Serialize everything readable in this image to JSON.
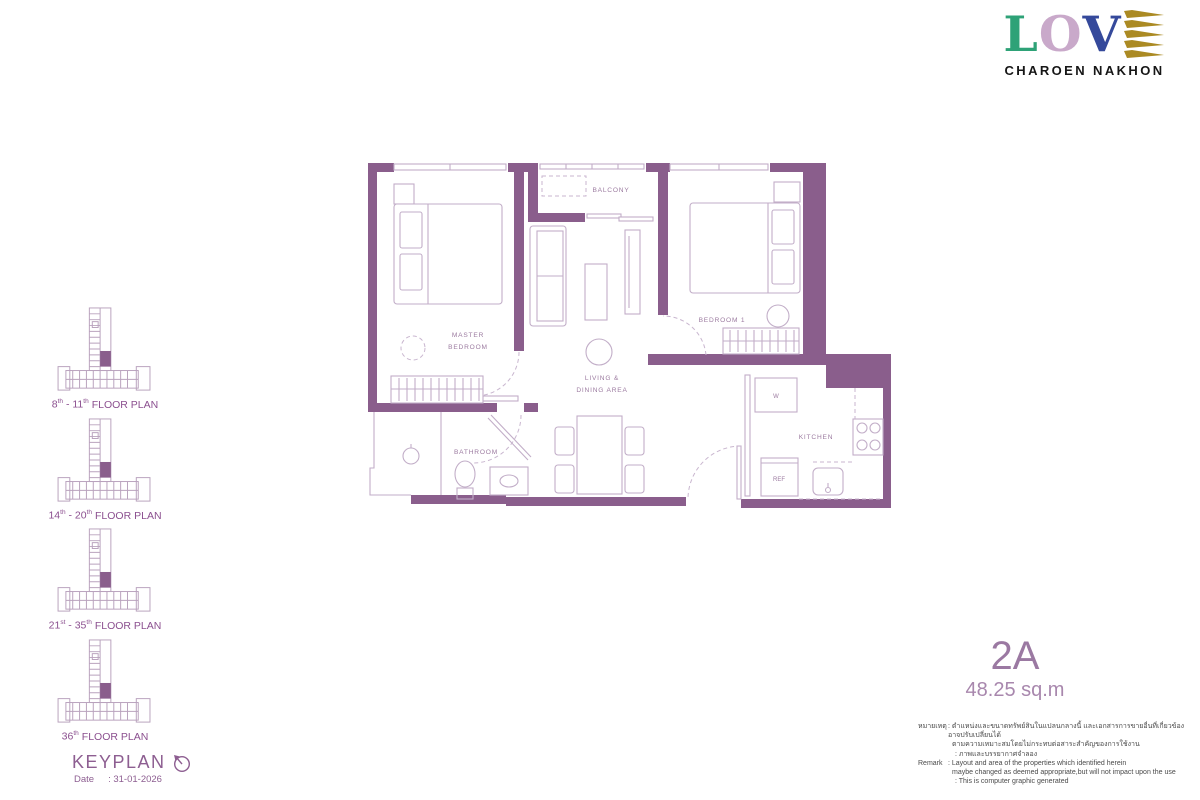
{
  "logo": {
    "letter1": "L",
    "letter2": "O",
    "letter3": "V",
    "subtitle": "CHAROEN NAKHON",
    "colors": {
      "letter1": "#2ea277",
      "letter2": "#c9a9ca",
      "letter3": "#35499b",
      "stylized_e": "#ab8a23",
      "subtitle": "#161616"
    }
  },
  "keyplan_section": {
    "plans": [
      {
        "start": "8",
        "start_sup": "th",
        "dash": " - ",
        "end": "11",
        "end_sup": "th",
        "suffix": "FLOOR PLAN"
      },
      {
        "start": "14",
        "start_sup": "th",
        "dash": " - ",
        "end": "20",
        "end_sup": "th",
        "suffix": "FLOOR PLAN"
      },
      {
        "start": "21",
        "start_sup": "st",
        "dash": " - ",
        "end": "35",
        "end_sup": "th",
        "suffix": "FLOOR PLAN"
      },
      {
        "start": "36",
        "start_sup": "th",
        "dash": "",
        "end": "",
        "end_sup": "",
        "suffix": "FLOOR PLAN"
      }
    ],
    "keyplan_label": "KEYPLAN",
    "date_label": "Date",
    "date_value": ": 31-01-2026"
  },
  "plan_labels": {
    "master_line1": "MASTER",
    "master_line2": "BEDROOM",
    "balcony": "BALCONY",
    "bedroom1": "BEDROOM 1",
    "living_line1": "LIVING &",
    "living_line2": "DINING AREA",
    "bathroom": "BATHROOM",
    "kitchen": "KITCHEN",
    "washer": "W",
    "fridge": "REF"
  },
  "unit": {
    "name": "2A",
    "area": "48.25 sq.m"
  },
  "remark": {
    "thai_label": "หมายเหตุ",
    "thai_line1": ": ตำแหน่งและขนาดทรัพย์สินในแปลนกลางนี้ และเอกสารการขายอื่นที่เกี่ยวข้อง อาจปรับเปลี่ยนได้",
    "thai_line2": "ตามความเหมาะสมโดยไม่กระทบต่อสาระสำคัญของการใช้งาน",
    "thai_line3": ": ภาพและบรรยากาศจำลอง",
    "en_label": "Remark",
    "en_line1": ": Layout and area of the properties which identified herein",
    "en_line2": "maybe changed as deemed appropriate,but will not impact upon the use",
    "en_line3": ": This is computer graphic generated"
  },
  "colors": {
    "wall": "#8a5e8c",
    "plan_line": "#c2aec8",
    "plan_label": "#9c7ba0",
    "accent_purple": "#8d5e91",
    "unit_name": "#9b79a2"
  }
}
